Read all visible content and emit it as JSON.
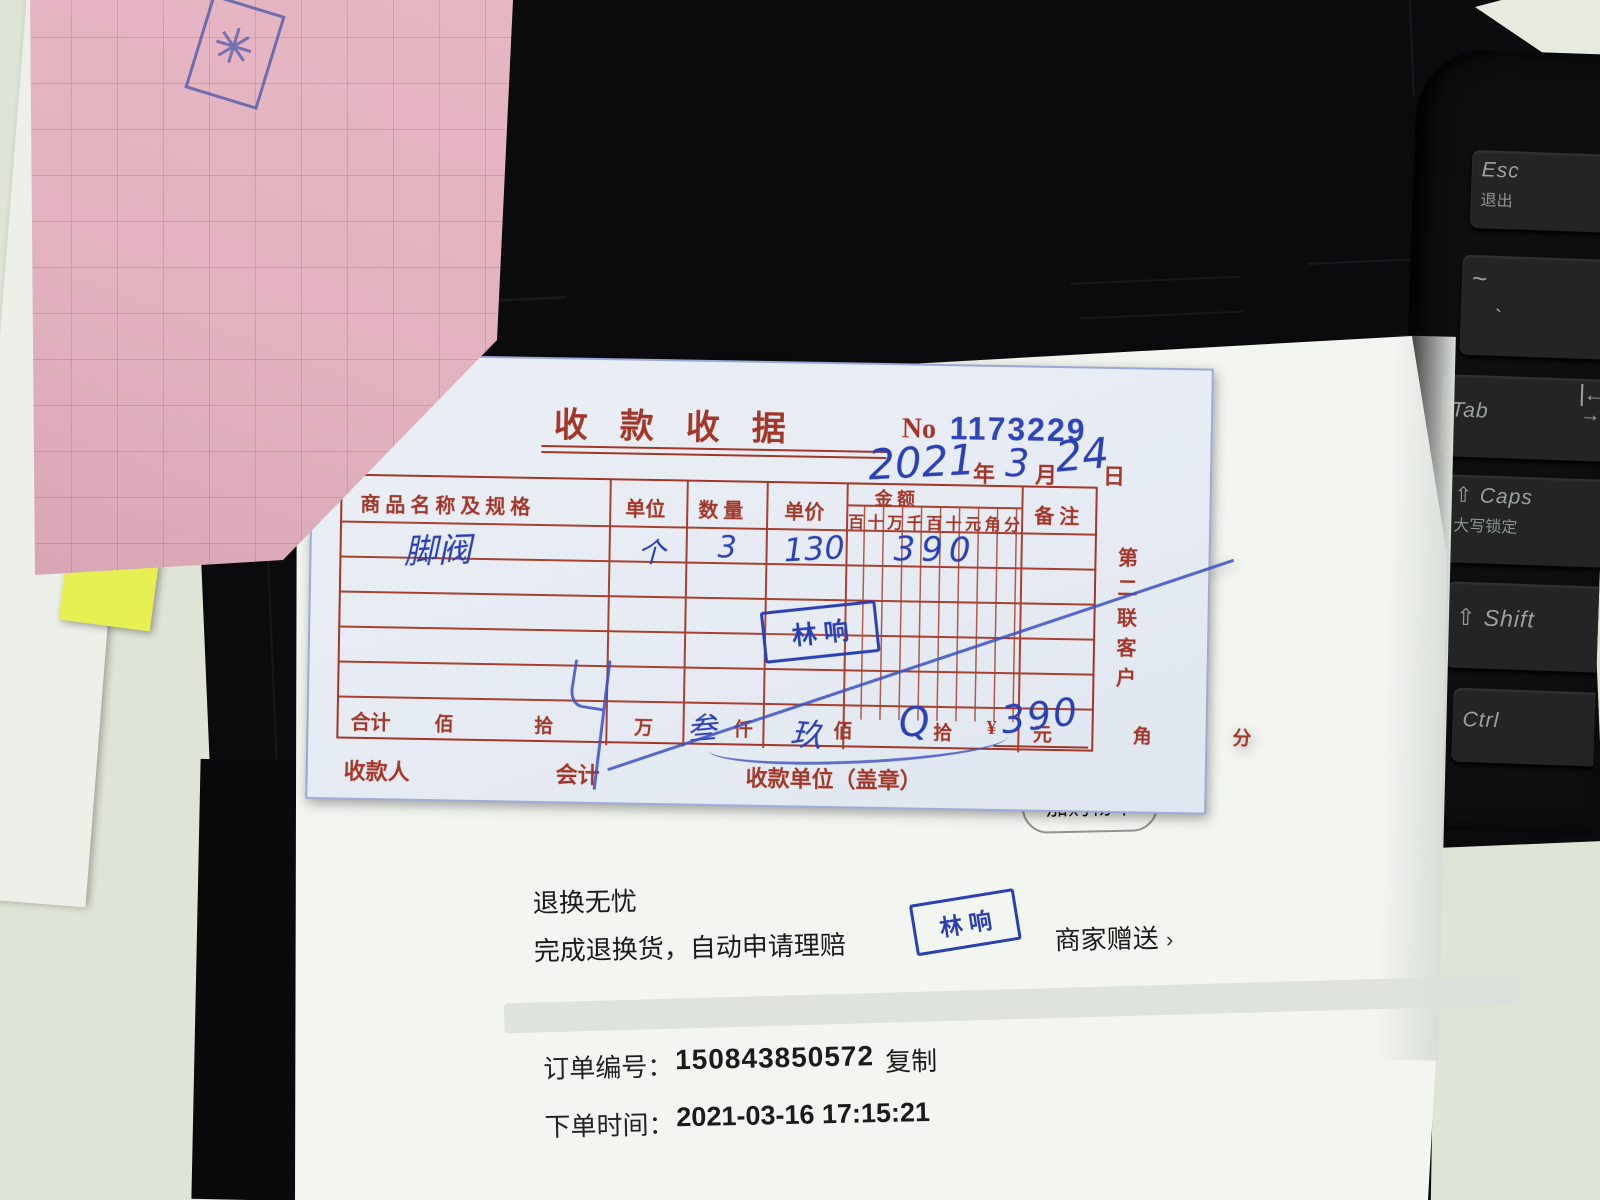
{
  "receipt": {
    "title": "收款收据",
    "no_label": "No",
    "no_value": "1173229",
    "date": {
      "year": "2021",
      "year_label": "年",
      "month": "3",
      "month_label": "月",
      "day": "24",
      "day_label": "日"
    },
    "table": {
      "headers": {
        "name": "商 品 名 称 及 规 格",
        "unit": "单位",
        "qty": "数  量",
        "price": "单价",
        "amount": "金        额",
        "amount_digits": "百十万千百十元角分",
        "remark": "备  注"
      },
      "row1": {
        "name": "脚阀",
        "unit": "个",
        "qty": "3",
        "price": "130",
        "amount": "390"
      },
      "total_label": "合计",
      "total_units": "佰 拾 万 仟 佰 拾 元 角 分",
      "total_currency": "¥",
      "total_hw_a": "叁",
      "total_hw_b": "玖",
      "total_hw_c": "Q",
      "total_amount": "390"
    },
    "footer": {
      "payee": "收款人",
      "accountant": "会计",
      "unit_seal": "收款单位（盖章）"
    },
    "copy_label": "第二联客户",
    "stamp": "林 响"
  },
  "page": {
    "add_cart": "加购物车",
    "line1": "退换无忧",
    "line2": "完成退换货，自动申请理赔",
    "stamp": "林 响",
    "gift": "商家赠送",
    "gift_chevron": "›",
    "order_no_label": "订单编号：",
    "order_no": "150843850572",
    "copy_btn": "复制",
    "order_time_label": "下单时间：",
    "order_time": "2021-03-16 17:15:21"
  },
  "keyboard": {
    "esc": "Esc",
    "esc_cn": "退出",
    "tilde": "~",
    "backtick": "`",
    "tab": "Tab",
    "caps_icon": "⇧",
    "caps": "Caps",
    "caps_cn": "大写锁定",
    "shift_icon": "⇧",
    "shift": "Shift",
    "ctrl": "Ctrl",
    "tab_arrow": "←",
    "tab_arrow2": "→"
  },
  "colors": {
    "ink_blue": "#2c40b5",
    "print_red": "#a23628",
    "stamp_blue": "#2b3fb2",
    "pink_paper": "#e3b2bf",
    "yellow_paper": "#e6f052",
    "desk": "#dfe5d6"
  }
}
